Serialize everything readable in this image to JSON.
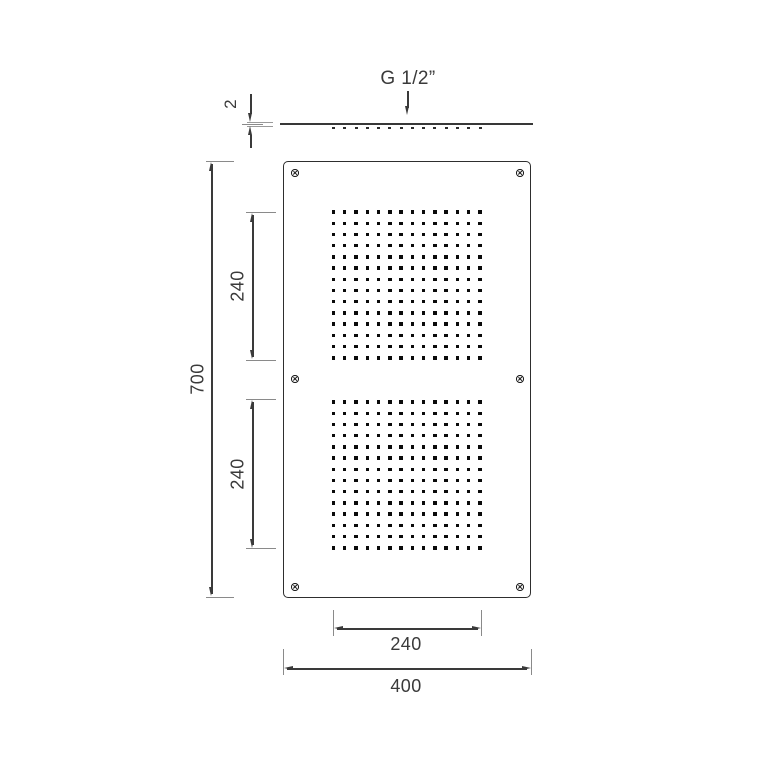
{
  "drawing": {
    "dimensions": {
      "thread": "G 1/2”",
      "thickness": "2",
      "total_height": "700",
      "panel_top_height": "240",
      "panel_bottom_height": "240",
      "panel_width": "240",
      "total_width": "400"
    },
    "perforation": {
      "panels": 2,
      "rows": 14,
      "cols": 14
    },
    "screw_count": 6,
    "colors": {
      "line": "#3a3a3a",
      "tick": "#8a8a8a",
      "dot": "#0a0a0a",
      "outline": "#2e2e2e"
    }
  }
}
